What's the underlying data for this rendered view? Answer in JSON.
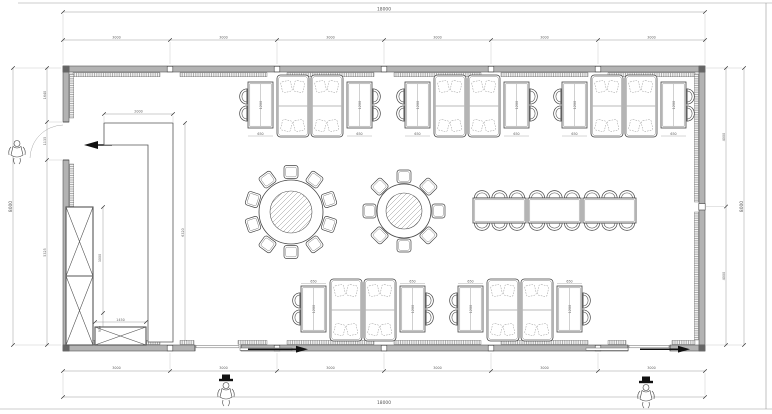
{
  "dimensions": {
    "overall_width": "18000",
    "overall_height": "8000",
    "top_segments": [
      "3000",
      "3000",
      "3000",
      "3000",
      "3000",
      "3000"
    ],
    "bottom_segments": [
      "3000",
      "3000",
      "3000",
      "3000",
      "3000",
      "3000"
    ],
    "left_segments": [
      "1640",
      "1135",
      "5325"
    ],
    "left_overall": "8000",
    "right_segments": [
      "4000",
      "4000"
    ],
    "right_overall": "8000",
    "partition_width": "2000",
    "partition_height": "6320",
    "cabinet_upper_height": "3000",
    "cabinet_lower_height": "900",
    "cabinet_box_width": "1450",
    "table_length": "1200",
    "table_width": "650"
  },
  "inventory": {
    "booth_seating_groups": 5,
    "booths_per_group": 2,
    "side_tables_per_group": 2,
    "round_table_large_seats": 10,
    "round_table_small_seats": 8,
    "long_table_sections": 3,
    "long_table_seats": 18,
    "storage_cabinets": 2,
    "entrances": 3,
    "person_figures": 3
  }
}
